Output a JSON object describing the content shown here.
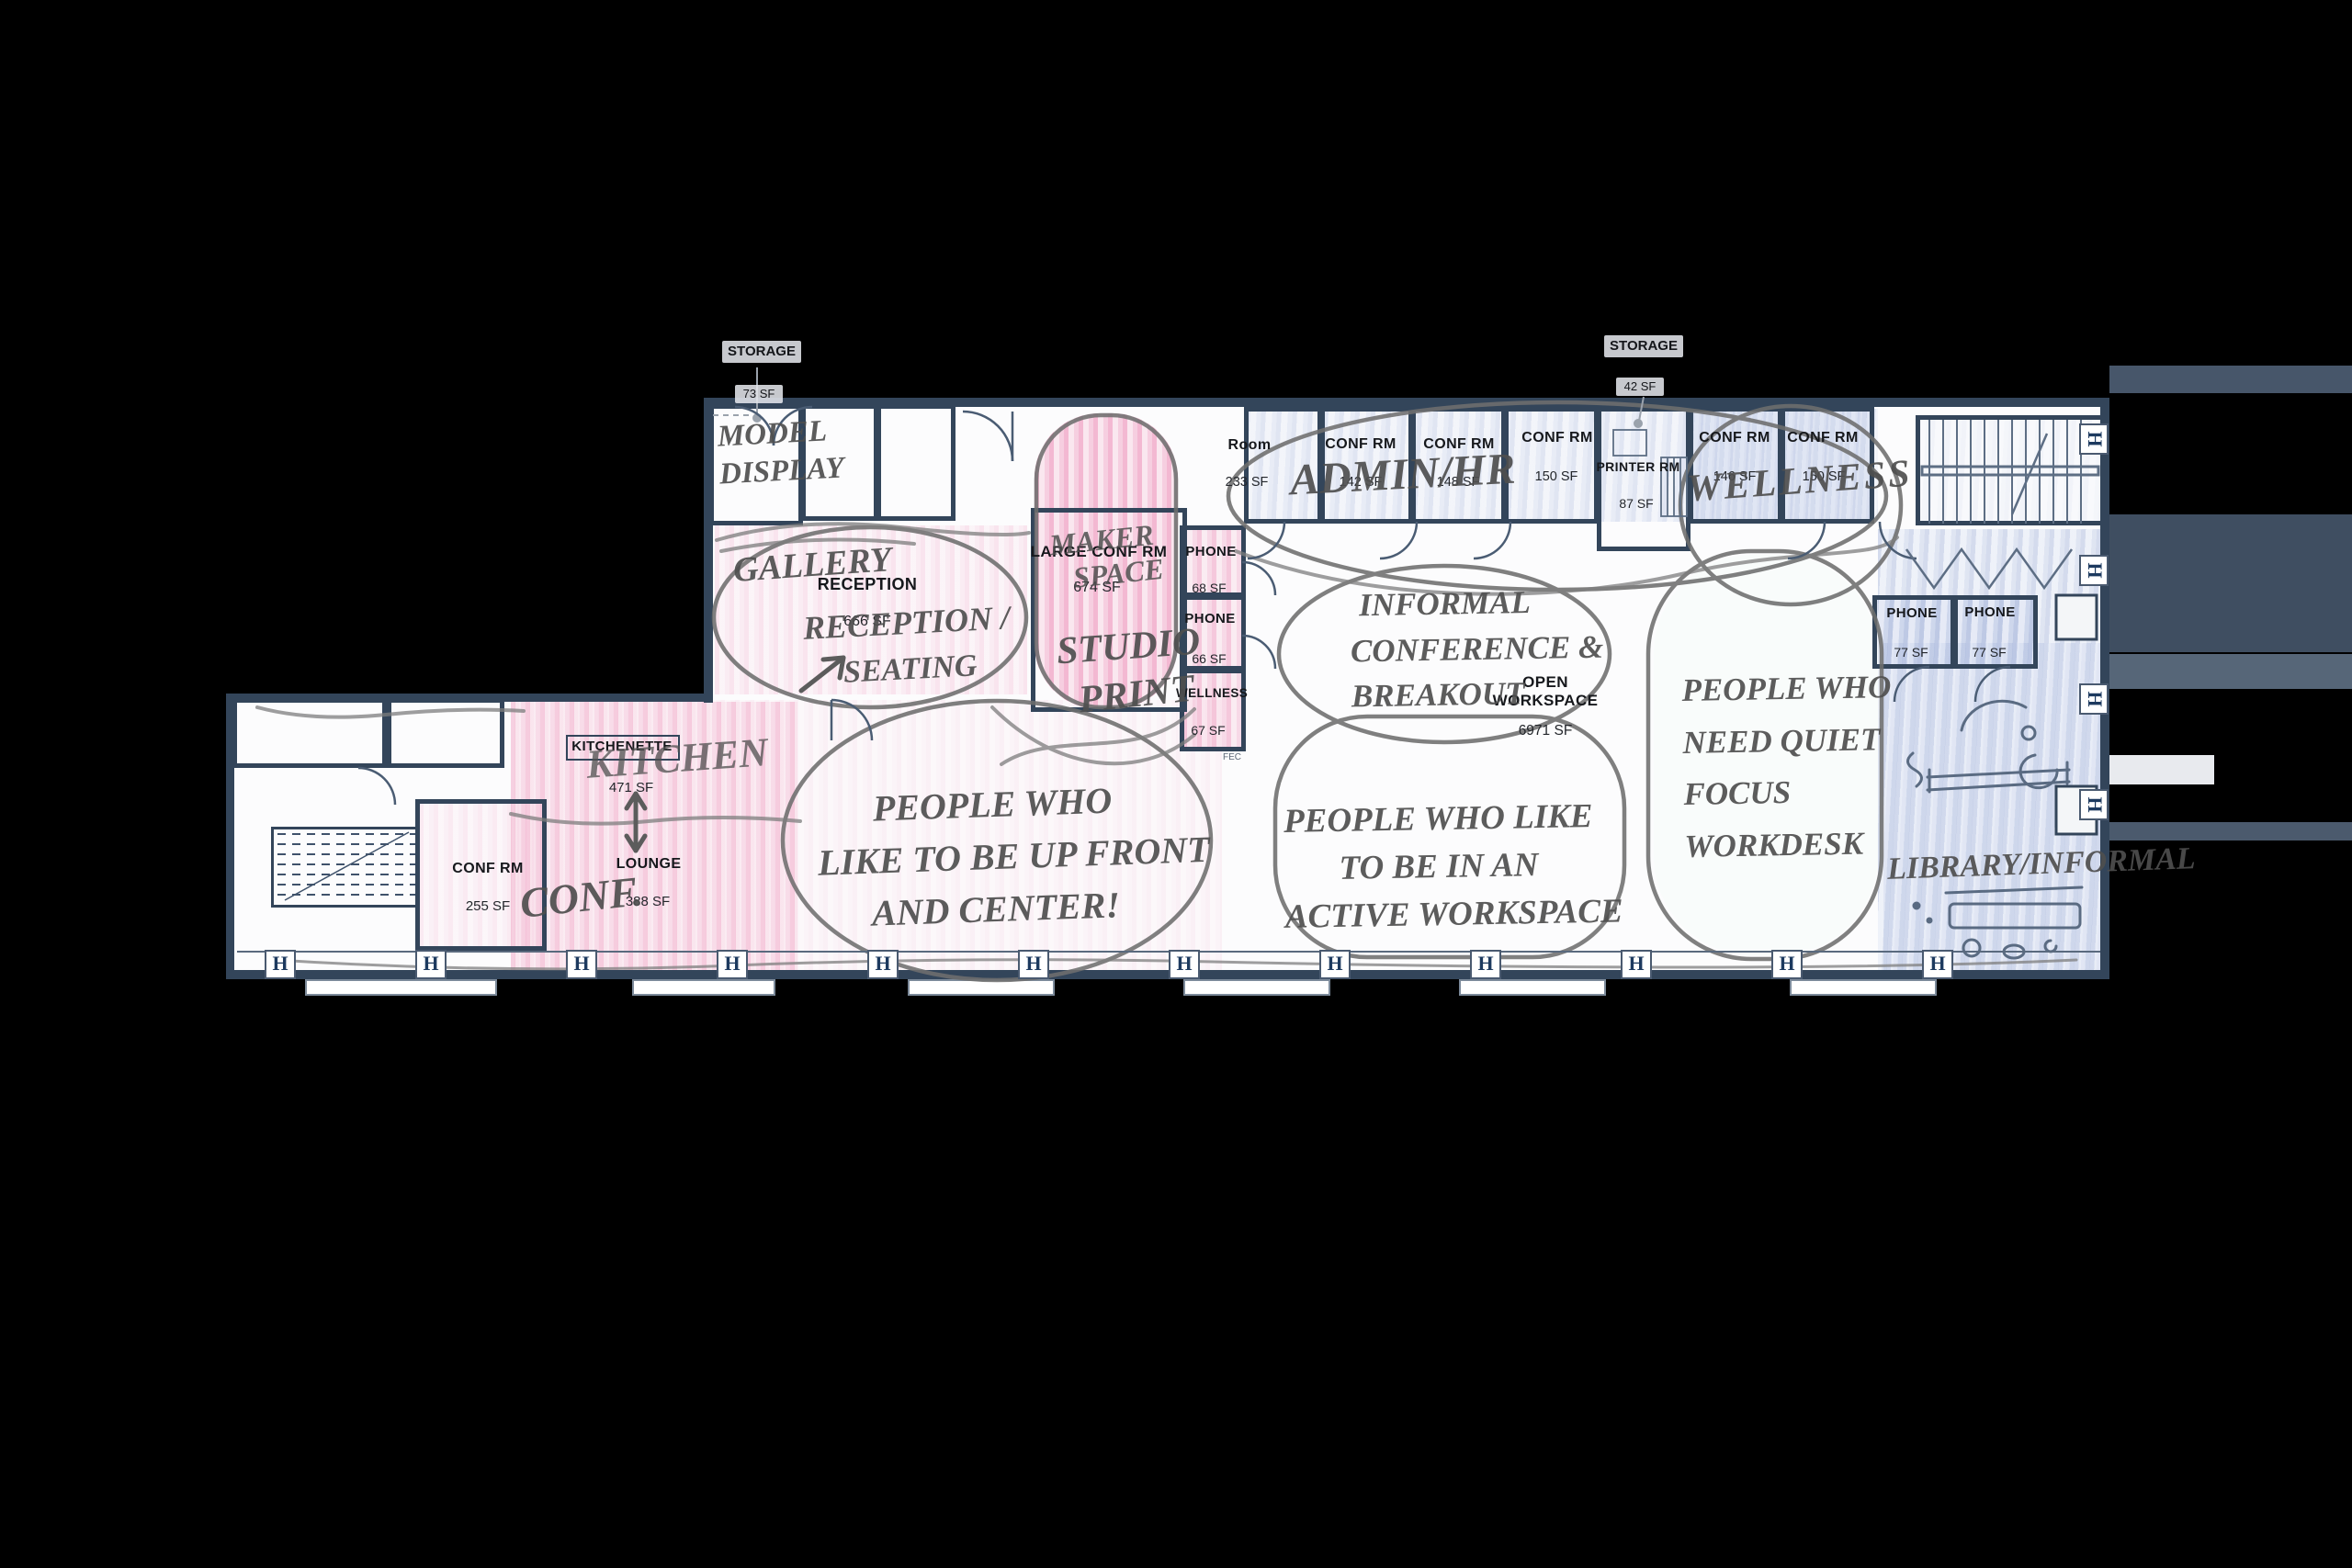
{
  "plan": {
    "storage_callouts": [
      {
        "label": "STORAGE",
        "sf": "73 SF"
      },
      {
        "label": "STORAGE",
        "sf": "42 SF"
      }
    ],
    "printed": {
      "reception": {
        "label": "RECEPTION",
        "sf": "666 SF"
      },
      "large_conf": {
        "label": "LARGE CONF RM",
        "sf": "674 SF"
      },
      "phone_68": {
        "label": "PHONE",
        "sf": "68 SF"
      },
      "phone_66": {
        "label": "PHONE",
        "sf": "66 SF"
      },
      "wellness": {
        "label": "WELLNESS",
        "sf": "67 SF"
      },
      "fec": "FEC",
      "room_233": {
        "label": "Room",
        "sf": "233 SF"
      },
      "conf_142": {
        "label": "CONF RM",
        "sf": "142 SF"
      },
      "conf_148": {
        "label": "CONF RM",
        "sf": "148 SF"
      },
      "conf_150a": {
        "label": "CONF RM",
        "sf": "150 SF"
      },
      "printer": {
        "label": "PRINTER RM",
        "sf": "87 SF"
      },
      "conf_146": {
        "label": "CONF RM",
        "sf": "146 SF"
      },
      "conf_150b": {
        "label": "CONF RM",
        "sf": "150 SF"
      },
      "open_workspace": {
        "label1": "OPEN",
        "label2": "WORKSPACE",
        "sf": "6971 SF"
      },
      "phone_77a": {
        "label": "PHONE",
        "sf": "77 SF"
      },
      "phone_77b": {
        "label": "PHONE",
        "sf": "77 SF"
      },
      "kitchenette": {
        "label": "KITCHENETTE",
        "sf": "471 SF"
      },
      "lounge": {
        "label": "LOUNGE",
        "sf": "388 SF"
      },
      "conf_255": {
        "label": "CONF RM",
        "sf": "255 SF"
      }
    },
    "handwritten": {
      "model_display": [
        "MODEL",
        "DISPLAY"
      ],
      "gallery": "GALLERY",
      "reception_seating": [
        "RECEPTION /",
        "SEATING"
      ],
      "maker_space": [
        "MAKER",
        "SPACE"
      ],
      "studio": "STUDIO",
      "print": "PRINT",
      "admin_hr": "ADMIN/HR",
      "wellness": "WELLNESS",
      "informal": [
        "INFORMAL",
        "CONFERENCE &",
        "BREAKOUT"
      ],
      "up_front": [
        "PEOPLE WHO",
        "LIKE TO BE UP FRONT",
        "AND CENTER!"
      ],
      "active": [
        "PEOPLE WHO LIKE",
        "TO BE IN AN",
        "ACTIVE WORKSPACE"
      ],
      "quiet": [
        "PEOPLE WHO",
        "NEED QUIET",
        "FOCUS",
        "WORKDESK"
      ],
      "library": "LIBRARY/INFORMAL",
      "kitchen": "KITCHEN",
      "conf": "CONF."
    },
    "symbols": {
      "column": "H"
    }
  }
}
